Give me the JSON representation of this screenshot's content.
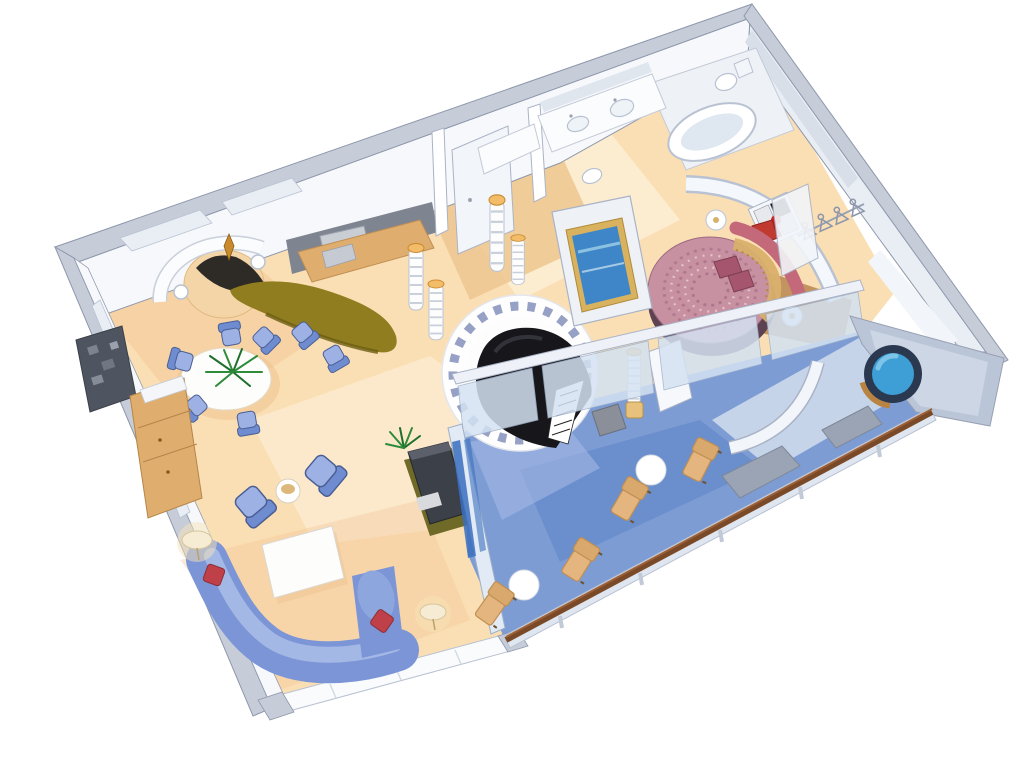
{
  "illustration": {
    "kind": "isometric-cutaway-floorplan",
    "subject": "luxury-suite-with-private-balcony",
    "background": "#ffffff"
  },
  "rooms": [
    "entry",
    "bar",
    "dining-area",
    "living-room",
    "piano-lounge",
    "bedroom",
    "bathroom",
    "walk-in-closet",
    "balcony"
  ],
  "furniture": [
    "grand-piano",
    "piano-bench",
    "round-bed",
    "sectional-sofa",
    "armchairs",
    "dining-table-with-palm",
    "dining-chairs",
    "bar-counter",
    "bar-chairs",
    "striped-columns",
    "wall-tv-panel",
    "diamond-artwork",
    "bathtub",
    "double-sinks",
    "toilet",
    "closet-hangers",
    "hot-tub",
    "sun-loungers",
    "balcony-tables",
    "privacy-dividers",
    "floor-lamps",
    "media-cabinet",
    "wood-cabinet",
    "coffee-table",
    "reception-counter"
  ],
  "palette": {
    "wall_roof": "#c6cdd9",
    "wall_edge": "#8e97ab",
    "wall_face": "#f6f8fb",
    "wall_shade": "#d9dfe9",
    "glass": "#e9eef5",
    "floor_cream": "#fbdfb4",
    "floor_cream_light": "#fdf2dc",
    "floor_shadow": "#f0c493",
    "floor_tan": "#eec892",
    "bar_backwall": "#7e8490",
    "bar_counter": "#8f7d1f",
    "bar_counter_dark": "#6b5c10",
    "cabinet_wood": "#dfae6e",
    "column_gold": "#f2bc68",
    "piano_black": "#17161a",
    "tile_ring": "#97a1c6",
    "sofa_blue": "#7b95d6",
    "sofa_blue_light": "#a9bbe8",
    "chair_blue": "#6f8cd0",
    "chair_blue_light": "#9db1e4",
    "cushion_red": "#bf4048",
    "table_white": "#fdfdfc",
    "lamp_cream": "#f6ecd4",
    "media_dark": "#3c4049",
    "plant_green": "#2e8b3a",
    "plant_green_dark": "#1f6f2d",
    "bed_spread": "#c791a2",
    "bed_pattern": "#a9718a",
    "bed_gold": "#d9b06c",
    "bed_base": "#5d4252",
    "headboard_rose": "#c4697a",
    "pillow_red": "#c03a30",
    "art_red": "#cc1f1f",
    "art_black": "#17171a",
    "rug_brown": "#bd8c55",
    "tv_frame_gold": "#d8b25e",
    "tv_screen": "#3f86c8",
    "balcony_blue": "#7d9cd4",
    "balcony_blue_dark": "#5d83c4",
    "balcony_blue_light": "#a3b8e4",
    "rail_wood": "#7a4a28",
    "lounger_tan": "#e4b57e",
    "lounger_shadow": "#c08f52",
    "divider_gray": "#9aa4b4",
    "hottub_rim": "#2b3950",
    "hottub_water": "#3e9ed6",
    "hottub_water_light": "#7cc4e8",
    "hottub_wood": "#b98342",
    "fixture_white": "#ffffff",
    "fixture_shade": "#dfe8f1"
  }
}
